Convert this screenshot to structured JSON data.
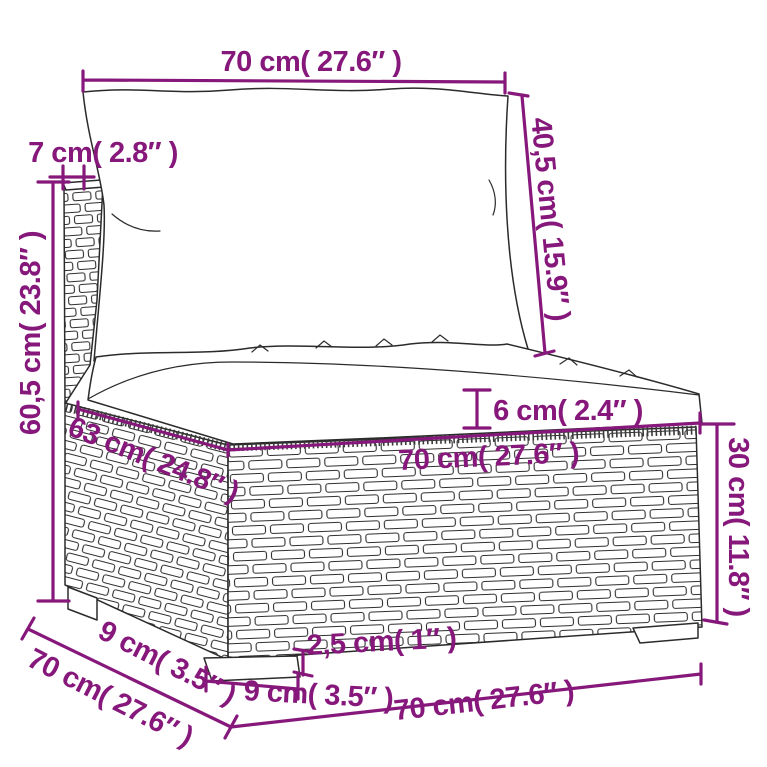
{
  "diagram": {
    "colors": {
      "dimension": "#87187B",
      "ink": "#2b2b2b",
      "background": "#ffffff"
    },
    "labels": {
      "top_width": "70 cm( 27.6″ )",
      "back_thickness": "7 cm( 2.8″ )",
      "back_cushion_height": "40,5 cm( 15.9″ )",
      "total_height": "60,5 cm( 23.8″ )",
      "seat_cushion_thickness": "6 cm( 2.4″ )",
      "seat_width": "70 cm( 27.6″ )",
      "seat_depth": "63 cm( 24.8″ )",
      "base_height": "30 cm( 11.8″ )",
      "bottom_depth": "70 cm( 27.6″ )",
      "foot_depth": "9 cm( 3.5″ )",
      "foot_width": "9 cm( 3.5″ )",
      "foot_height": "2,5 cm( 1″ )",
      "bottom_width": "70 cm( 27.6″ )"
    }
  }
}
